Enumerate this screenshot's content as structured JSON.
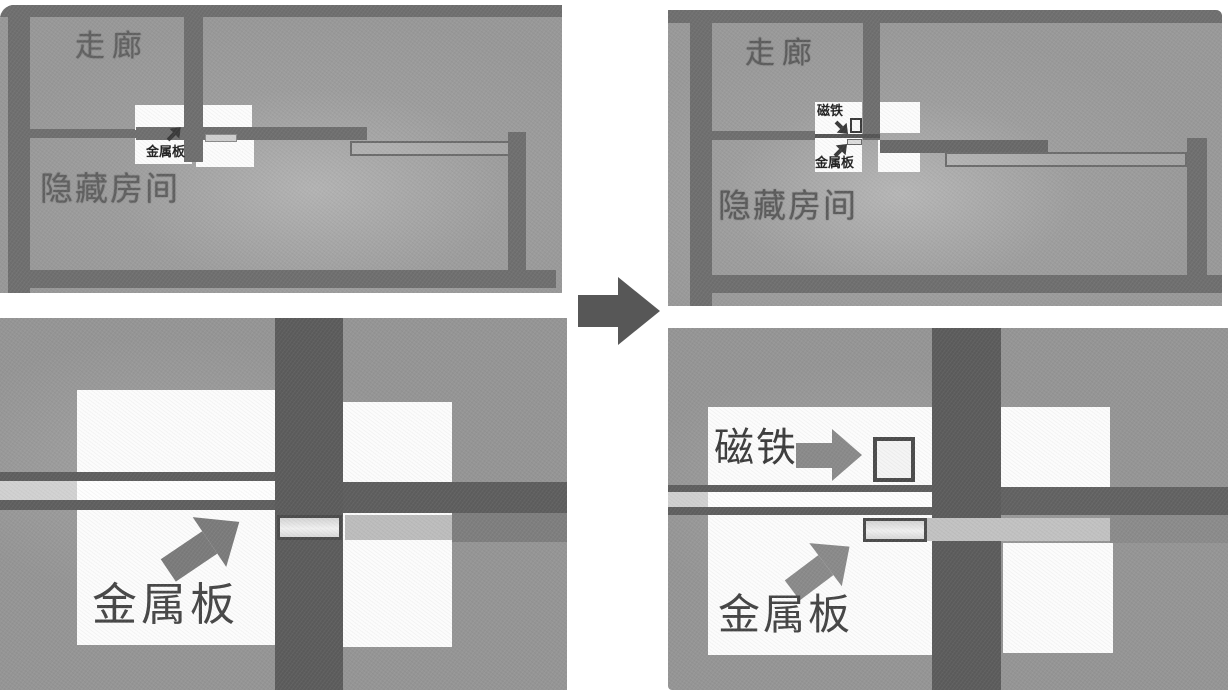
{
  "figure": {
    "description_labels": {
      "corridor": "走廊",
      "hidden_room": "隐藏房间",
      "metal_plate": "金属板",
      "magnet": "磁铁"
    }
  },
  "panels": {
    "top_left": {
      "corridor_label": "走廊",
      "hidden_room_label": "隐藏房间",
      "metal_plate_label": "金属板"
    },
    "top_right": {
      "corridor_label": "走廊",
      "hidden_room_label": "隐藏房间",
      "magnet_label": "磁铁",
      "metal_plate_label": "金属板"
    },
    "bottom_left": {
      "metal_plate_label": "金属板"
    },
    "bottom_right": {
      "magnet_label": "磁铁",
      "metal_plate_label": "金属板"
    }
  },
  "colors": {
    "panel_background": "#9a9a9a",
    "wall_dark": "#5c5c5c",
    "wall_soft": "#6f6f6f",
    "room_white": "#fcfcfc",
    "corridor_strip": "#d9d9d9",
    "plate_fill": "#e3e3e3",
    "magnet_fill": "#f4f4f4",
    "arrow_gray": "#7d7d7d",
    "transition_arrow": "#575757",
    "label_text": "#4a4a4a"
  }
}
